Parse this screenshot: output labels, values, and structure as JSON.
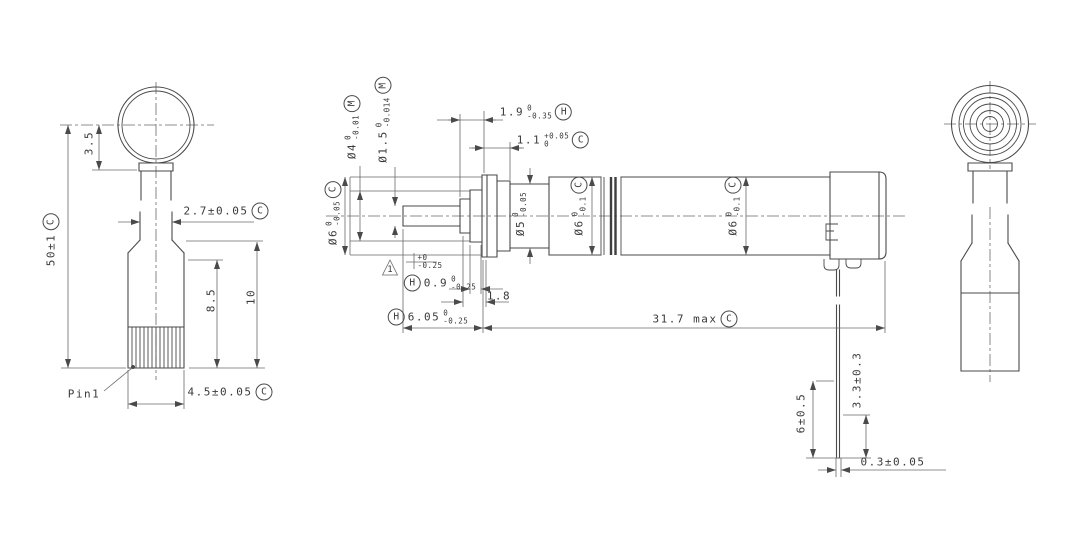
{
  "drawing": {
    "background": "#ffffff",
    "line_color": "#4a4a4a",
    "text_color": "#3a3a3a"
  },
  "left_view": {
    "pin_label": "Pin1",
    "dims": {
      "offset_35": {
        "value": "3.5"
      },
      "overall_50": {
        "value": "50±1",
        "flag": "C"
      },
      "width_27": {
        "value": "2.7±0.05",
        "flag": "C"
      },
      "len_85": {
        "value": "8.5"
      },
      "len_10": {
        "value": "10"
      },
      "width_45": {
        "value": "4.5±0.05",
        "flag": "C"
      }
    }
  },
  "center_view": {
    "dims": {
      "dia_4": {
        "value": "Ø4",
        "tol_up": "0",
        "tol_dn": "-0.01",
        "flag": "M"
      },
      "dia_1_5": {
        "value": "Ø1.5",
        "tol_up": "0",
        "tol_dn": "-0.014",
        "flag": "M"
      },
      "dia_6_sleeve": {
        "value": "Ø6",
        "tol_up": "0",
        "tol_dn": "-0.05",
        "flag": "C"
      },
      "dia_5": {
        "value": "Ø5",
        "tol_up": "0",
        "tol_dn": "-0.05"
      },
      "dia_6_front": {
        "value": "Ø6",
        "tol_up": "0",
        "tol_dn": "-0.1",
        "flag": "C"
      },
      "dia_6_rear": {
        "value": "Ø6",
        "tol_up": "0",
        "tol_dn": "-0.1",
        "flag": "C"
      },
      "len_1_9": {
        "value": "1.9",
        "tol_up": "0",
        "tol_dn": "-0.35",
        "flag": "H"
      },
      "len_1_1": {
        "value": "1.1",
        "tol_up": "+0.05",
        "tol_dn": "0",
        "flag": "C"
      },
      "len_0_9": {
        "value": "0.9",
        "tol_up": "0",
        "tol_dn": "-0.25",
        "flag": "H"
      },
      "len_1_8": {
        "value": "1.8"
      },
      "len_6_05": {
        "value": "6.05",
        "tol_up": "0",
        "tol_dn": "-0.25",
        "flag": "H"
      },
      "len_total": {
        "value": "31.7 max",
        "flag": "C"
      },
      "lead_6": {
        "value": "6±0.5"
      },
      "lead_3_3": {
        "value": "3.3±0.3"
      },
      "lead_0_3": {
        "value": "0.3±0.05"
      }
    },
    "notes": {
      "tri_flag": "1",
      "tol_up": "+0",
      "tol_dn": "-0.25"
    }
  }
}
